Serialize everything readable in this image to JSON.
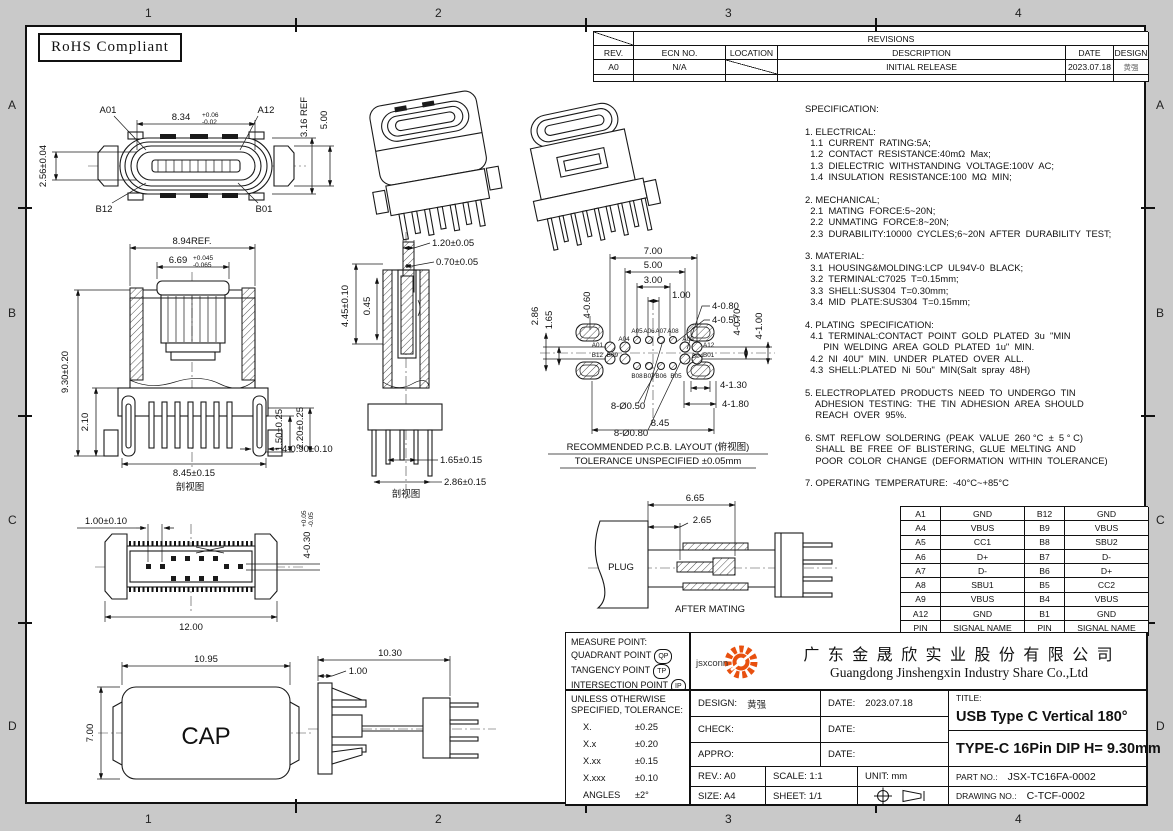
{
  "sheet": {
    "background": "#c9c9c9",
    "paper": "#ffffff",
    "line_color": "#1a1a1a",
    "accent_orange": "#e8500f",
    "rohs_label": "RoHS Compliant",
    "zone_cols_top": [
      "1",
      "2",
      "3",
      "4"
    ],
    "zone_cols_bottom": [
      "1",
      "2",
      "3",
      "4"
    ],
    "zone_rows_left": [
      "A",
      "B",
      "C",
      "D"
    ],
    "zone_rows_right": [
      "A",
      "B",
      "C",
      "D"
    ]
  },
  "revisions": {
    "title": "REVISIONS",
    "headers": [
      "REV.",
      "ECN  NO.",
      "LOCATION",
      "DESCRIPTION",
      "DATE",
      "DESIGN"
    ],
    "row": {
      "rev": "A0",
      "ecn": "N/A",
      "description": "INITIAL  RELEASE",
      "date": "2023.07.18",
      "design": "黄强"
    }
  },
  "specification": {
    "lines": [
      "SPECIFICATION:",
      "",
      "1. ELECTRICAL:",
      "  1.1  CURRENT  RATING:5A;",
      "  1.2  CONTACT  RESISTANCE:40mΩ  Max;",
      "  1.3  DIELECTRIC  WITHSTANDING  VOLTAGE:100V  AC;",
      "  1.4  INSULATION  RESISTANCE:100  MΩ  MIN;",
      "",
      "2. MECHANICAL;",
      "  2.1  MATING  FORCE:5~20N;",
      "  2.2  UNMATING  FORCE:8~20N;",
      "  2.3  DURABILITY:10000  CYCLES;6~20N  AFTER  DURABILITY  TEST;",
      "",
      "3. MATERIAL:",
      "  3.1  HOUSING&MOLDING:LCP  UL94V-0  BLACK;",
      "  3.2  TERMINAL:C7025  T=0.15mm;",
      "  3.3  SHELL:SUS304  T=0.30mm;",
      "  3.4  MID  PLATE:SUS304  T=0.15mm;",
      "",
      "4. PLATING  SPECIFICATION:",
      "  4.1  TERMINAL:CONTACT  POINT  GOLD  PLATED  3u  \"MIN",
      "       PIN  WELDING  AREA  GOLD  PLATED  1u\"  MIN.",
      "  4.2  NI  40U\"  MIN.  UNDER  PLATED  OVER  ALL.",
      "  4.3  SHELL:PLATED  Ni  50u\"  MIN(Salt  spray  48H)",
      "",
      "5. ELECTROPLATED  PRODUCTS  NEED  TO  UNDERGO  TIN",
      "    ADHESION  TESTING:  THE  TIN  ADHESION  AREA  SHOULD",
      "    REACH  OVER  95%.",
      "",
      "6. SMT  REFLOW  SOLDERING  (PEAK  VALUE  260 °C  ±  5 ° C)",
      "    SHALL  BE  FREE  OF  BLISTERING,  GLUE  MELTING  AND",
      "    POOR  COLOR  CHANGE  (DEFORMATION  WITHIN  TOLERANCE)",
      "",
      "7. OPERATING  TEMPERATURE:  -40°C~+85°C"
    ]
  },
  "pin_table": {
    "rows": [
      [
        "A1",
        "GND",
        "B12",
        "GND"
      ],
      [
        "A4",
        "VBUS",
        "B9",
        "VBUS"
      ],
      [
        "A5",
        "CC1",
        "B8",
        "SBU2"
      ],
      [
        "A6",
        "D+",
        "B7",
        "D-"
      ],
      [
        "A7",
        "D-",
        "B6",
        "D+"
      ],
      [
        "A8",
        "SBU1",
        "B5",
        "CC2"
      ],
      [
        "A9",
        "VBUS",
        "B4",
        "VBUS"
      ],
      [
        "A12",
        "GND",
        "B1",
        "GND"
      ]
    ],
    "footer": [
      "PIN",
      "SIGNAL NAME",
      "PIN",
      "SIGNAL NAME"
    ]
  },
  "title_block": {
    "measure": {
      "l1": "MEASURE  POINT:",
      "l2": "QUADRANT  POINT",
      "b2": "QP",
      "l3": "TANGENCY  POINT",
      "b3": "TP",
      "l4": "INTERSECTION  POINT",
      "b4": "IP"
    },
    "tol": {
      "h1": "UNLESS  OTHERWISE",
      "h2": "SPECIFIED,  TOLERANCE:",
      "x1": "X.",
      "v1": "±0.25",
      "x2": "X.x",
      "v2": "±0.20",
      "x3": "X.xx",
      "v3": "±0.15",
      "x4": "X.xxx",
      "v4": "±0.10",
      "x5": "ANGLES",
      "v5": "±2°"
    },
    "logo_text": "jsxconn",
    "company_cn": "广 东 金 晟 欣 实 业 股 份 有 限 公 司",
    "company_en": "Guangdong Jinshengxin Industry Share Co.,Ltd",
    "design_label": "DESIGN:",
    "design_value": "黄强",
    "date1_label": "DATE:",
    "date1_value": "2023.07.18",
    "check_label": "CHECK:",
    "date2_label": "DATE:",
    "appro_label": "APPRO:",
    "date3_label": "DATE:",
    "title_label": "TITLE:",
    "title_line1": "USB Type C Vertical 180°",
    "title_line2": "TYPE-C 16Pin DIP H= 9.30mm",
    "rev": "REV.: A0",
    "scale": "SCALE: 1:1",
    "unit": "UNIT: mm",
    "size": "SIZE: A4",
    "sheet_no": "SHEET: 1/1",
    "part_label": "PART  NO.:",
    "part_value": "JSX-TC16FA-0002",
    "drawing_label": "DRAWING  NO.:",
    "drawing_value": "C-TCF-0002"
  },
  "drawings": {
    "top_view": {
      "label_a01": "A01",
      "label_a12": "A12",
      "label_b12": "B12",
      "label_b01": "B01",
      "dim_width": "8.34",
      "dim_width_plus": "+0.06",
      "dim_width_minus": "-0.02",
      "dim_height": "2.56±0.04",
      "dim_ref": "3.16 REF",
      "dim_outer": "5.00"
    },
    "front_section": {
      "dim_total_width": "8.94REF.",
      "dim_tongue": "6.69",
      "dim_tongue_plus": "+0.045",
      "dim_tongue_minus": "-0.065",
      "dim_height": "9.30±0.20",
      "dim_flange": "2.10",
      "dim_leg1": "1.50±0.25",
      "dim_leg2": "2.20±0.25",
      "dim_holes": "4-0.90±0.10",
      "dim_span": "8.45±0.15",
      "caption": "剖视图"
    },
    "side_section": {
      "dim_pin_w": "1.20±0.05",
      "dim_pin_w2": "0.70±0.05",
      "dim_depth": "4.45±0.10",
      "dim_offset": "0.45",
      "dim_pitch1": "1.65±0.15",
      "dim_pitch2": "2.86±0.15",
      "caption": "剖视图"
    },
    "pcb_layout": {
      "dim_700": "7.00",
      "dim_500": "5.00",
      "dim_300": "3.00",
      "dim_100": "1.00",
      "dim_4_080": "4-0.80",
      "dim_4_050": "4-0.50",
      "dim_4_060": "4-0.60",
      "dim_286": "2.86",
      "dim_165": "1.65",
      "dim_4_070": "4-0.70",
      "dim_4_100": "4-1.00",
      "dim_8_050": "8-Ø0.50",
      "dim_8_080": "8-Ø0.80",
      "dim_4_130": "4-1.30",
      "dim_4_180": "4-1.80",
      "dim_845": "8.45",
      "pin_a01": "A01",
      "pin_b12": "B12",
      "pin_a04": "A04",
      "pin_a05": "A05",
      "pin_a06": "A06",
      "pin_a07": "A07",
      "pin_a08": "A08",
      "pin_a09": "A09",
      "pin_a12": "A12",
      "pin_b01": "B01",
      "pin_b04": "B04",
      "pin_b05": "B05",
      "pin_b06": "B06",
      "pin_b07": "B07",
      "pin_b08": "B08",
      "pin_b09": "B09",
      "caption1": "RECOMMENDED   P.C.B.  LAYOUT (俯视图)",
      "caption2": "TOLERANCE  UNSPECIFIED  ±0.05mm"
    },
    "bottom_view": {
      "dim_pad": "1.00±0.10",
      "dim_width": "12.00",
      "dim_hole": "4-0.30",
      "dim_hole_plus": "+0.05",
      "dim_hole_minus": "-0.05"
    },
    "after_mating": {
      "plug_label": "PLUG",
      "dim_depth": "6.65",
      "dim_insert": "2.65",
      "caption": "AFTER  MATING"
    },
    "cap_view": {
      "dim_width": "10.95",
      "dim_height": "7.00",
      "label": "CAP",
      "dim_side": "10.30",
      "dim_plate": "1.00"
    }
  }
}
